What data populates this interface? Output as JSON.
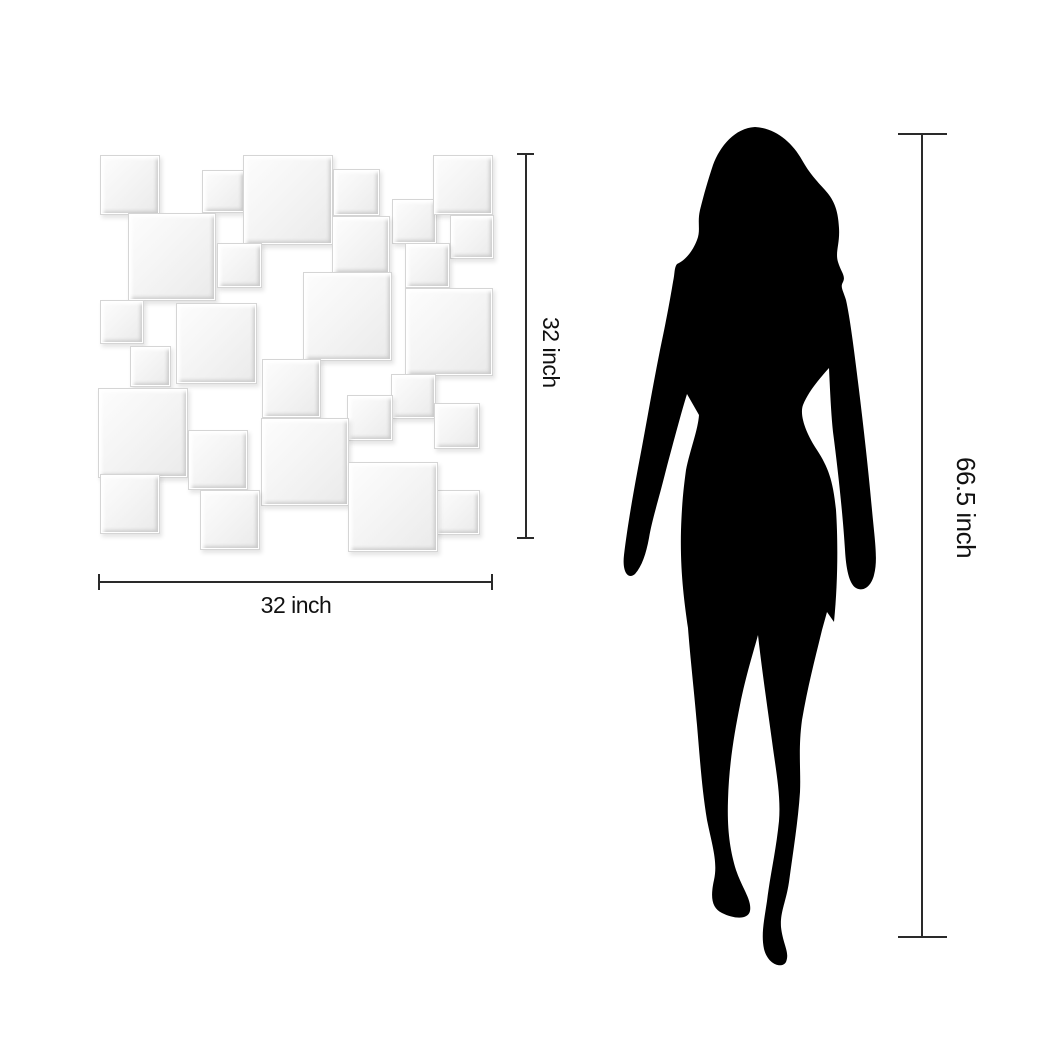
{
  "page": {
    "description": "Size illustration of a square-collage wall mirror shown next to a woman silhouette for scale",
    "background": "#ffffff"
  },
  "mirror": {
    "name": "collage wall mirror of overlapping beveled square tiles",
    "tile_face_color": "#f3f3f3",
    "tile_edge_color": "#d5d5d5",
    "tiles": [
      {
        "x": 100,
        "y": 155,
        "size": 58
      },
      {
        "x": 202,
        "y": 170,
        "size": 41
      },
      {
        "x": 243,
        "y": 155,
        "size": 88
      },
      {
        "x": 333,
        "y": 169,
        "size": 45
      },
      {
        "x": 392,
        "y": 199,
        "size": 43
      },
      {
        "x": 433,
        "y": 155,
        "size": 58
      },
      {
        "x": 450,
        "y": 215,
        "size": 42
      },
      {
        "x": 128,
        "y": 213,
        "size": 86
      },
      {
        "x": 217,
        "y": 243,
        "size": 43
      },
      {
        "x": 332,
        "y": 216,
        "size": 56
      },
      {
        "x": 405,
        "y": 243,
        "size": 43
      },
      {
        "x": 100,
        "y": 300,
        "size": 42
      },
      {
        "x": 176,
        "y": 303,
        "size": 79
      },
      {
        "x": 303,
        "y": 272,
        "size": 87
      },
      {
        "x": 405,
        "y": 288,
        "size": 86
      },
      {
        "x": 130,
        "y": 346,
        "size": 39
      },
      {
        "x": 262,
        "y": 359,
        "size": 57
      },
      {
        "x": 98,
        "y": 388,
        "size": 88
      },
      {
        "x": 391,
        "y": 374,
        "size": 43
      },
      {
        "x": 347,
        "y": 395,
        "size": 44
      },
      {
        "x": 434,
        "y": 403,
        "size": 44
      },
      {
        "x": 188,
        "y": 430,
        "size": 58
      },
      {
        "x": 261,
        "y": 418,
        "size": 86
      },
      {
        "x": 100,
        "y": 474,
        "size": 58
      },
      {
        "x": 200,
        "y": 490,
        "size": 58
      },
      {
        "x": 435,
        "y": 490,
        "size": 43
      },
      {
        "x": 348,
        "y": 462,
        "size": 88
      }
    ]
  },
  "figure": {
    "name": "woman silhouette",
    "color": "#000000"
  },
  "dimensions": {
    "unit": "inch",
    "line_color": "#2a2a2a",
    "mirror_width": {
      "value": 32,
      "label": "32 inch"
    },
    "mirror_height": {
      "value": 32,
      "label": "32 inch"
    },
    "figure_height": {
      "value": 66.5,
      "label": "66.5 inch"
    }
  }
}
